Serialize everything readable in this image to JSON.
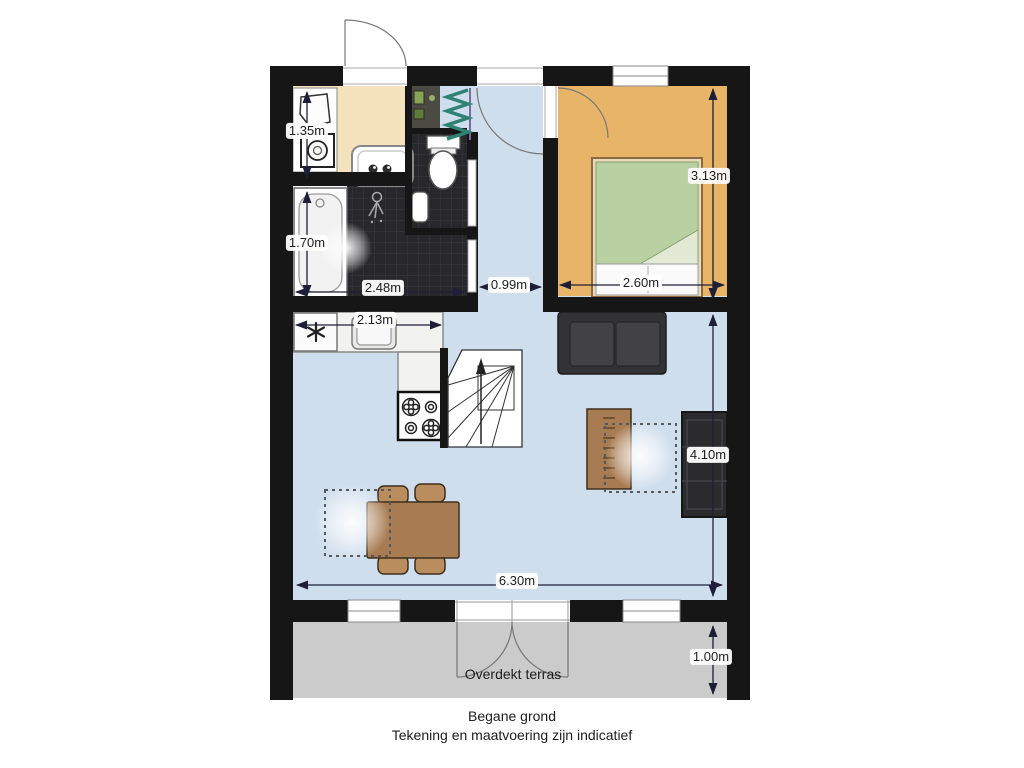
{
  "plan": {
    "floor_title": "Begane grond",
    "disclaimer": "Tekening en maatvoering zijn indicatief",
    "terrace_label": "Overdekt terras",
    "dimensions": {
      "storage_width": "1.35m",
      "bathroom_depth": "1.70m",
      "bathroom_width": "2.48m",
      "kitchen_width": "2.13m",
      "hallway_width": "0.99m",
      "bedroom_width": "2.60m",
      "bedroom_depth": "3.13m",
      "livingroom_depth": "4.10m",
      "livingroom_width": "6.30m",
      "terrace_depth": "1.00m"
    },
    "colors": {
      "wall": "#161616",
      "storage_room": "#f3e2bb",
      "bedroom": "#e8b568",
      "living_and_hall": "#cfdeed",
      "bathroom_tile": "#28282a",
      "terrace": "#cbcbcb",
      "bed_cover": "#b9d0a2",
      "wood_furniture": "#a87c52",
      "dimension_lines": "#1e1e38"
    }
  }
}
